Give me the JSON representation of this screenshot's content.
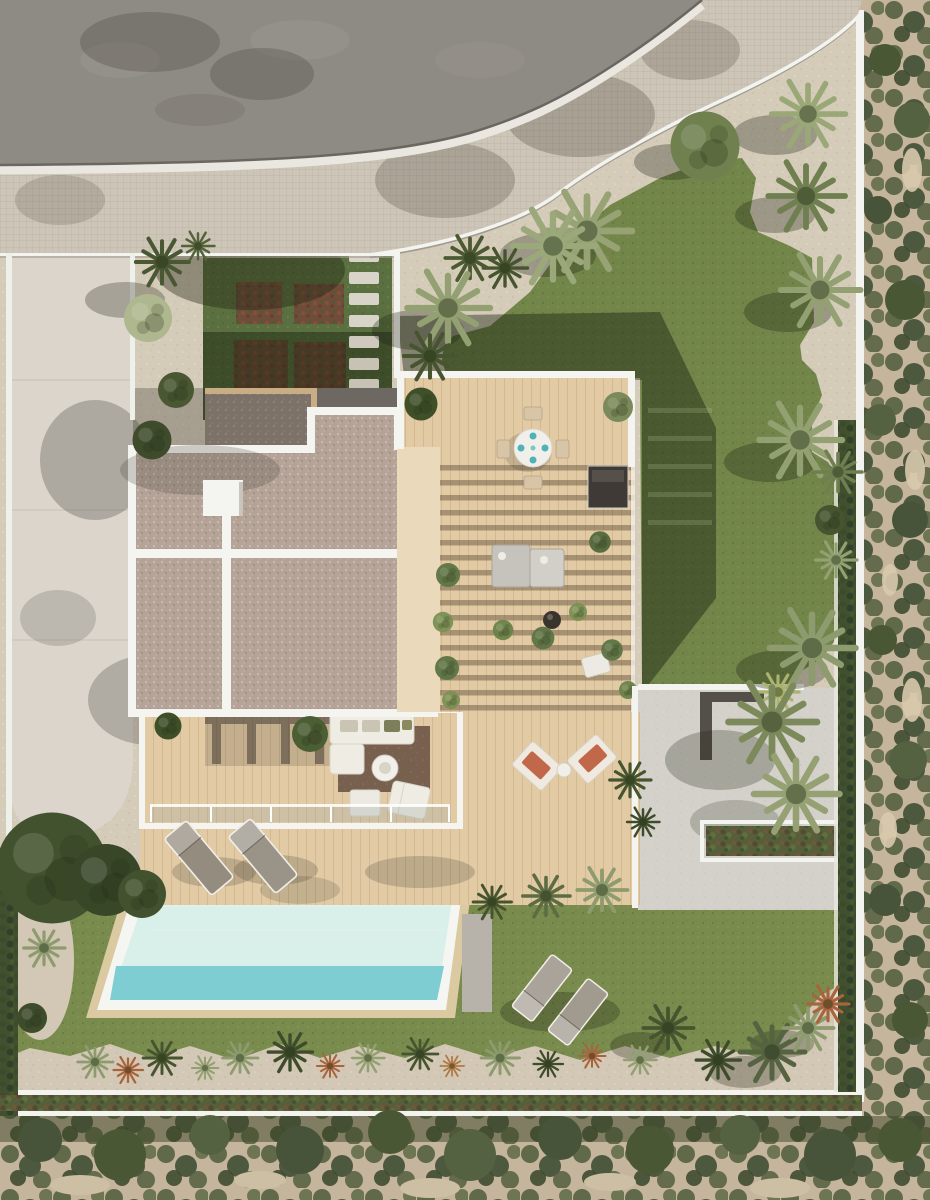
{
  "scene": {
    "type": "aerial-3d-architectural-render",
    "subject": "top-down view of a modern villa plot with flat roofs, wooden decks, pergola terrace, swimming pool, lawns and mediterranean scrubland",
    "palette": {
      "road": "#8e8a84",
      "sidewalk": "#cdc5b7",
      "wall": "#f3f3ef",
      "gravel": "#d5cbb9",
      "driveway": "#dbd5cc",
      "garden_lawn": "#5b7040",
      "lawn": "#73864a",
      "lawn_bright": "#798c4e",
      "path_gravel": "#d3c8b6",
      "roof": "#b4a396",
      "roof_shadow": "#7c7268",
      "deck": "#e2cba4",
      "deck_bright": "#ead9bb",
      "patio": "#d4d1ca",
      "pool_water": "#d9efe9",
      "pool_teal": "#7ecdd2",
      "pool_coping": "#f5f6f2",
      "pool_apron": "#dbc9a2",
      "scrub_sand": "#c6b59d",
      "hedge": "#41502f",
      "rug": "#77614e",
      "sofa": "#efece3",
      "lounger_gray": "#948c7f",
      "lounger_cushion": "#c2684a",
      "plate_teal": "#4db3b6"
    },
    "objects": [
      {
        "name": "asphalt-road",
        "count": 1
      },
      {
        "name": "tiled-sidewalk",
        "count": 1
      },
      {
        "name": "boundary-wall",
        "count": 1
      },
      {
        "name": "driveway",
        "count": 1
      },
      {
        "name": "vegetable-garden-bed",
        "count": 4
      },
      {
        "name": "stepping-stone",
        "count": 8
      },
      {
        "name": "flat-roof-section",
        "count": 2
      },
      {
        "name": "roof-chimney",
        "count": 1
      },
      {
        "name": "roof-skylight",
        "count": 1
      },
      {
        "name": "dining-table",
        "count": 1
      },
      {
        "name": "dining-chair",
        "count": 4
      },
      {
        "name": "table-setting",
        "count": 4
      },
      {
        "name": "pergola-terrace",
        "count": 1
      },
      {
        "name": "outdoor-sofa",
        "count": 2
      },
      {
        "name": "coffee-table",
        "count": 1
      },
      {
        "name": "area-rug",
        "count": 1
      },
      {
        "name": "sun-lounger",
        "count": 6
      },
      {
        "name": "swimming-pool",
        "count": 1
      },
      {
        "name": "lawn-area",
        "count": 3
      },
      {
        "name": "palm-tree",
        "count": 28
      },
      {
        "name": "olive-tree",
        "count": 1
      },
      {
        "name": "hedge-planter",
        "count": 3
      },
      {
        "name": "scrubland-strip",
        "count": 2
      }
    ]
  }
}
